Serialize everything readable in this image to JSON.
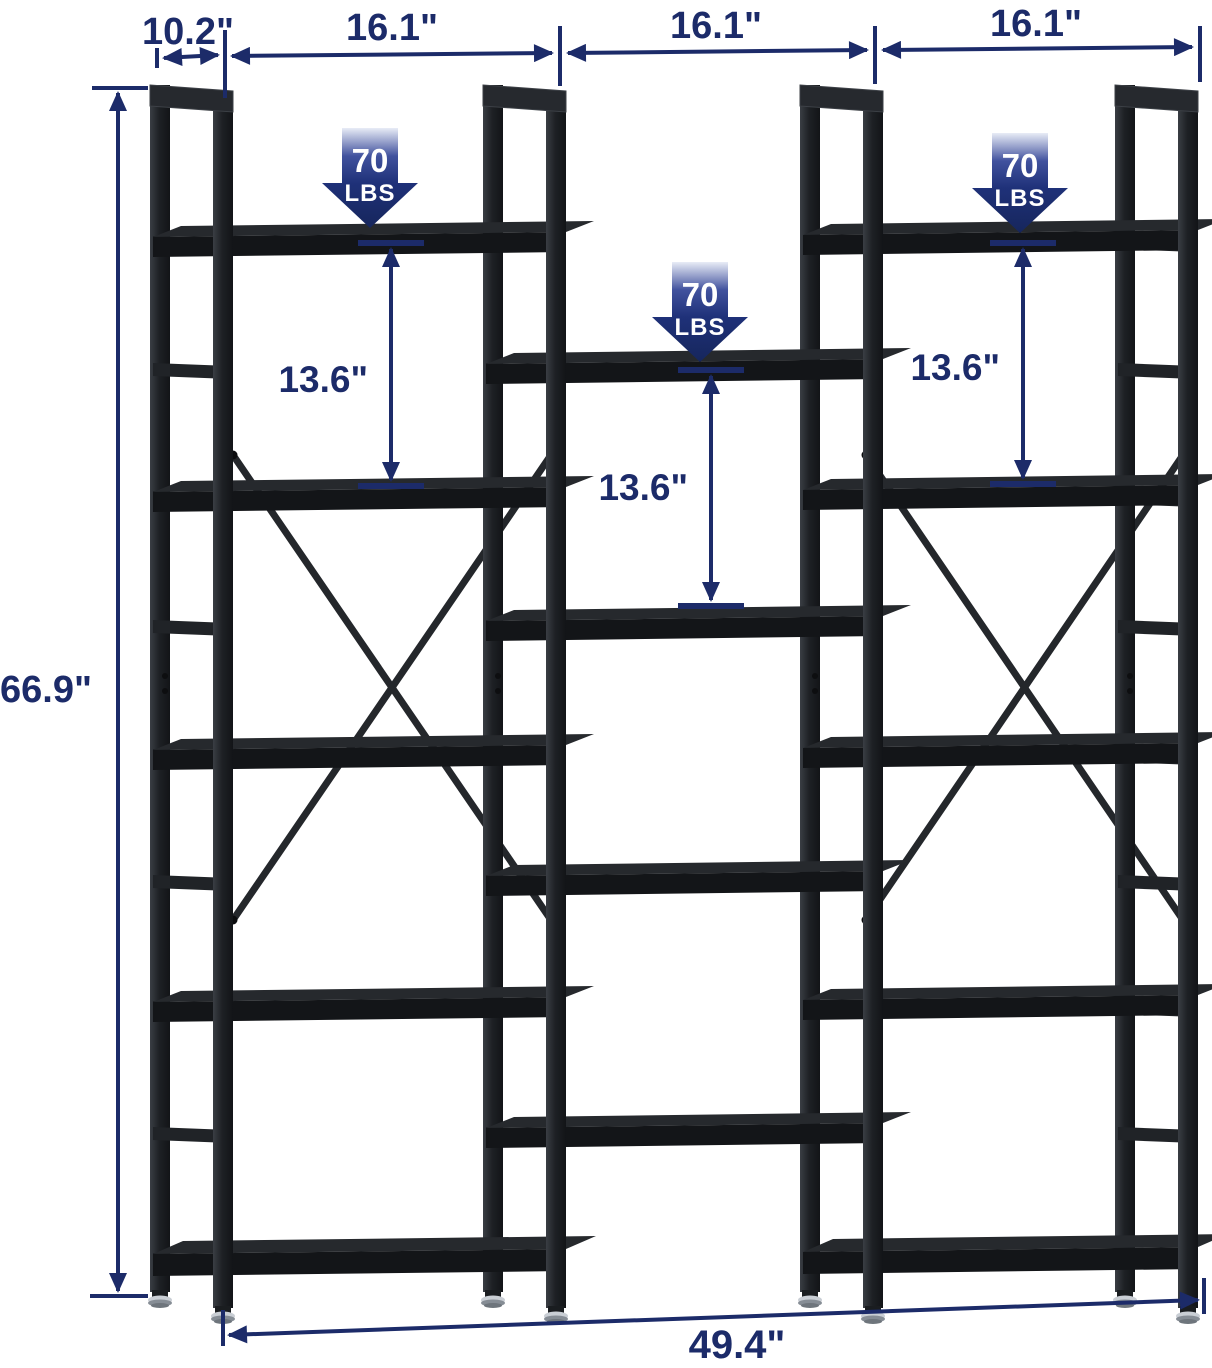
{
  "dimensions": {
    "depth": "10.2\"",
    "section_widths": [
      "16.1\"",
      "16.1\"",
      "16.1\""
    ],
    "height": "66.9\"",
    "shelf_spacings": [
      "13.6\"",
      "13.6\"",
      "13.6\""
    ],
    "total_width": "49.4\""
  },
  "load_badges": [
    {
      "value": "70",
      "unit": "LBS"
    },
    {
      "value": "70",
      "unit": "LBS"
    },
    {
      "value": "70",
      "unit": "LBS"
    }
  ],
  "colors": {
    "annotation_navy": "#1c2b69",
    "badge_gradient_top": "#e8ecf6",
    "badge_gradient_bottom": "#16265c",
    "frame_black": "#24272b",
    "shelf_black": "#131518",
    "foot_chrome": "#c9ced4",
    "background": "#ffffff"
  }
}
